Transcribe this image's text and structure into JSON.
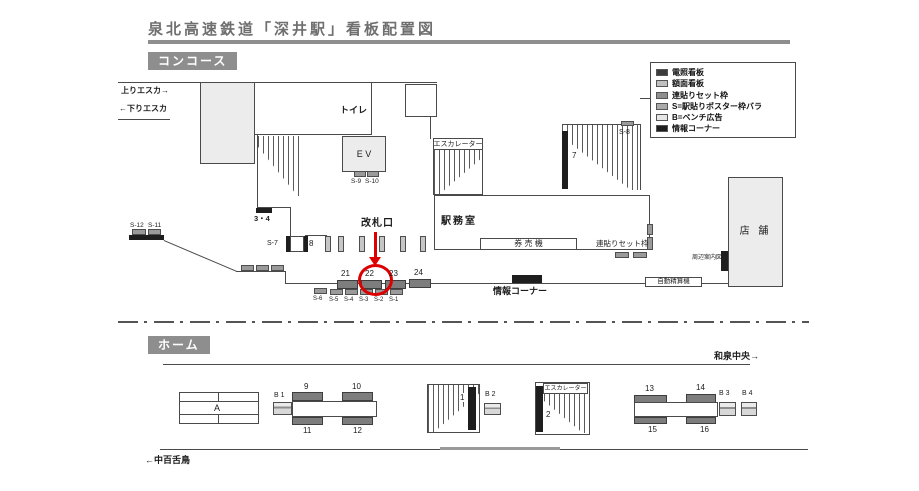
{
  "title": "泉北高速鉄道「深井駅」看板配置図",
  "colors": {
    "highlight_red": "#dd0000"
  },
  "sections": {
    "concourse": "コンコース",
    "platform": "ホーム"
  },
  "legend": [
    {
      "label": "電照看板",
      "color": "#3c3c3c"
    },
    {
      "label": "額面看板",
      "color": "#c0c0c0"
    },
    {
      "label": "連貼りセット枠",
      "color": "#8f8f8f"
    },
    {
      "label": "S=駅貼りポスター枠バラ",
      "color": "#aaaaaa"
    },
    {
      "label": "B=ベンチ広告",
      "color": "#e5e5e5"
    },
    {
      "label": "情報コーナー",
      "color": "#1e1e1e"
    }
  ],
  "concourse": {
    "up_escalator": "上りエスカ→",
    "down_escalator": "←下りエスカ",
    "toilet": "トイレ",
    "elevator": "E V",
    "escalator": "エスカレーター",
    "station_office": "駅務室",
    "ticket_machines": "券 売 機",
    "ticket_gate": "改札口",
    "info_corner": "情報コーナー",
    "poster_set_frame": "連貼りセット枠",
    "store": "店 舗",
    "area_guide_map": "周辺案内図",
    "fare_adjustment_machine": "自動精算機",
    "signs": {
      "s12": "S-12",
      "s11": "S-11",
      "s7": "S-7",
      "g8": "8",
      "g34": "3・4",
      "s9": "S-9",
      "s10": "S-10",
      "g7": "7",
      "s8": "S-8",
      "g21": "21",
      "g22": "22",
      "g23": "23",
      "g24": "24",
      "s6": "S-6",
      "s5": "S-5",
      "s4": "S-4",
      "s3": "S-3",
      "s2": "S-2",
      "s1": "S-1"
    }
  },
  "platform": {
    "direction_right": "和泉中央→",
    "direction_left": "←中百舌鳥",
    "escalator": "エスカレーター",
    "signs": {
      "a": "A",
      "b1": "B 1",
      "b2": "B 2",
      "b3": "B 3",
      "b4": "B 4",
      "g9": "9",
      "g10": "10",
      "g11": "11",
      "g12": "12",
      "g1": "1",
      "g2": "2",
      "g13": "13",
      "g14": "14",
      "g15": "15",
      "g16": "16"
    }
  }
}
